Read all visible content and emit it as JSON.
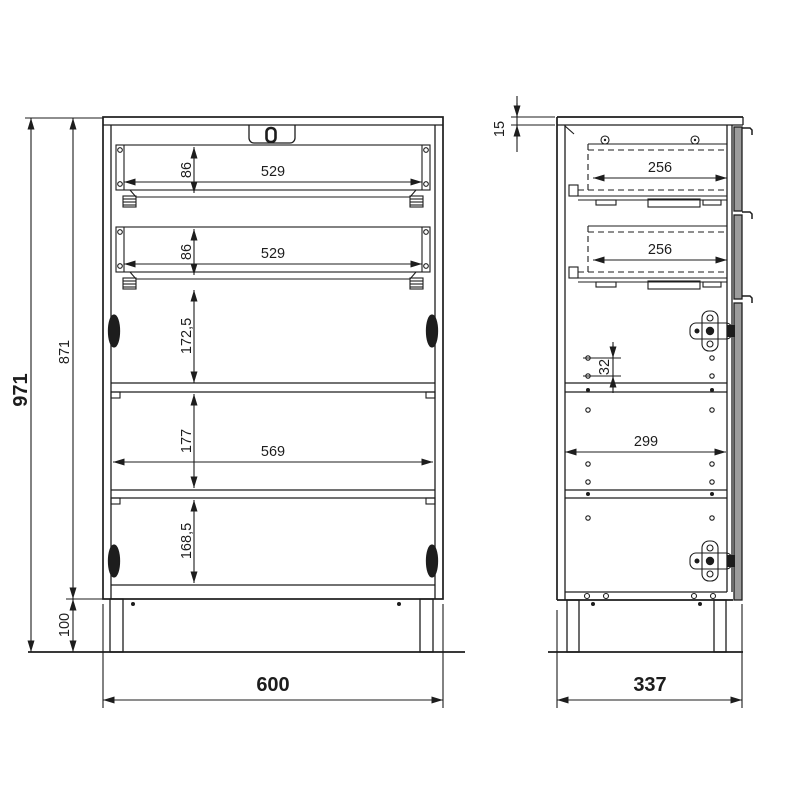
{
  "drawing": {
    "background": "#ffffff",
    "ink_color": "#1d1d1d",
    "front_panel_fill": "#9c9c9c",
    "front_view": {
      "dims": {
        "overall_height": "971",
        "carcass_height": "871",
        "leg_height": "100",
        "overall_width": "600",
        "drawer1_height": "86",
        "drawer1_width": "529",
        "drawer2_height": "86",
        "drawer2_width": "529",
        "opening1_height": "172,5",
        "opening2_height": "177",
        "interior_width": "569",
        "opening3_height": "168,5"
      }
    },
    "side_view": {
      "dims": {
        "top_panel_thickness": "15",
        "drawer1_depth": "256",
        "drawer2_depth": "256",
        "shelf_hole_pitch": "32",
        "interior_depth": "299",
        "overall_depth": "337"
      }
    }
  }
}
